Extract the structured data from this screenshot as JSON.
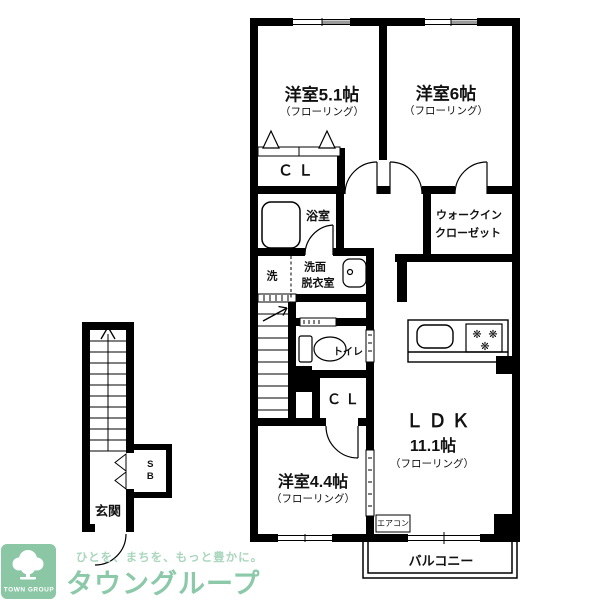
{
  "labels": {
    "room51": "洋室5.1帖",
    "room51_floor": "（フローリング）",
    "room6": "洋室6帖",
    "room6_floor": "（フローリング）",
    "closet1": "ＣＬ",
    "bathroom": "浴室",
    "wic_line1": "ウォークイン",
    "wic_line2": "クローゼット",
    "washer": "洗",
    "washroom_line1": "洗面",
    "washroom_line2": "脱衣室",
    "toilet": "トイレ",
    "closet2": "ＣＬ",
    "ldk": "ＬＤＫ",
    "ldk_size": "11.1帖",
    "ldk_floor": "（フローリング）",
    "room44": "洋室4.4帖",
    "room44_floor": "（フローリング）",
    "aircon": "エアコン",
    "balcony": "バルコニー",
    "entrance": "玄関",
    "shoe_box": "SB"
  },
  "logo": {
    "tagline": "ひとを、まちを、もっと豊かに。",
    "brand": "タウングループ",
    "brand_en": "TOWN GROUP"
  },
  "colors": {
    "wall": "#000000",
    "logo_green": "#8bc6a5",
    "tagline_green": "#a9d6bd",
    "brand_green": "#8bc9a9",
    "window_gray": "#9a9a9a"
  },
  "icons": {
    "burner": "❋"
  }
}
